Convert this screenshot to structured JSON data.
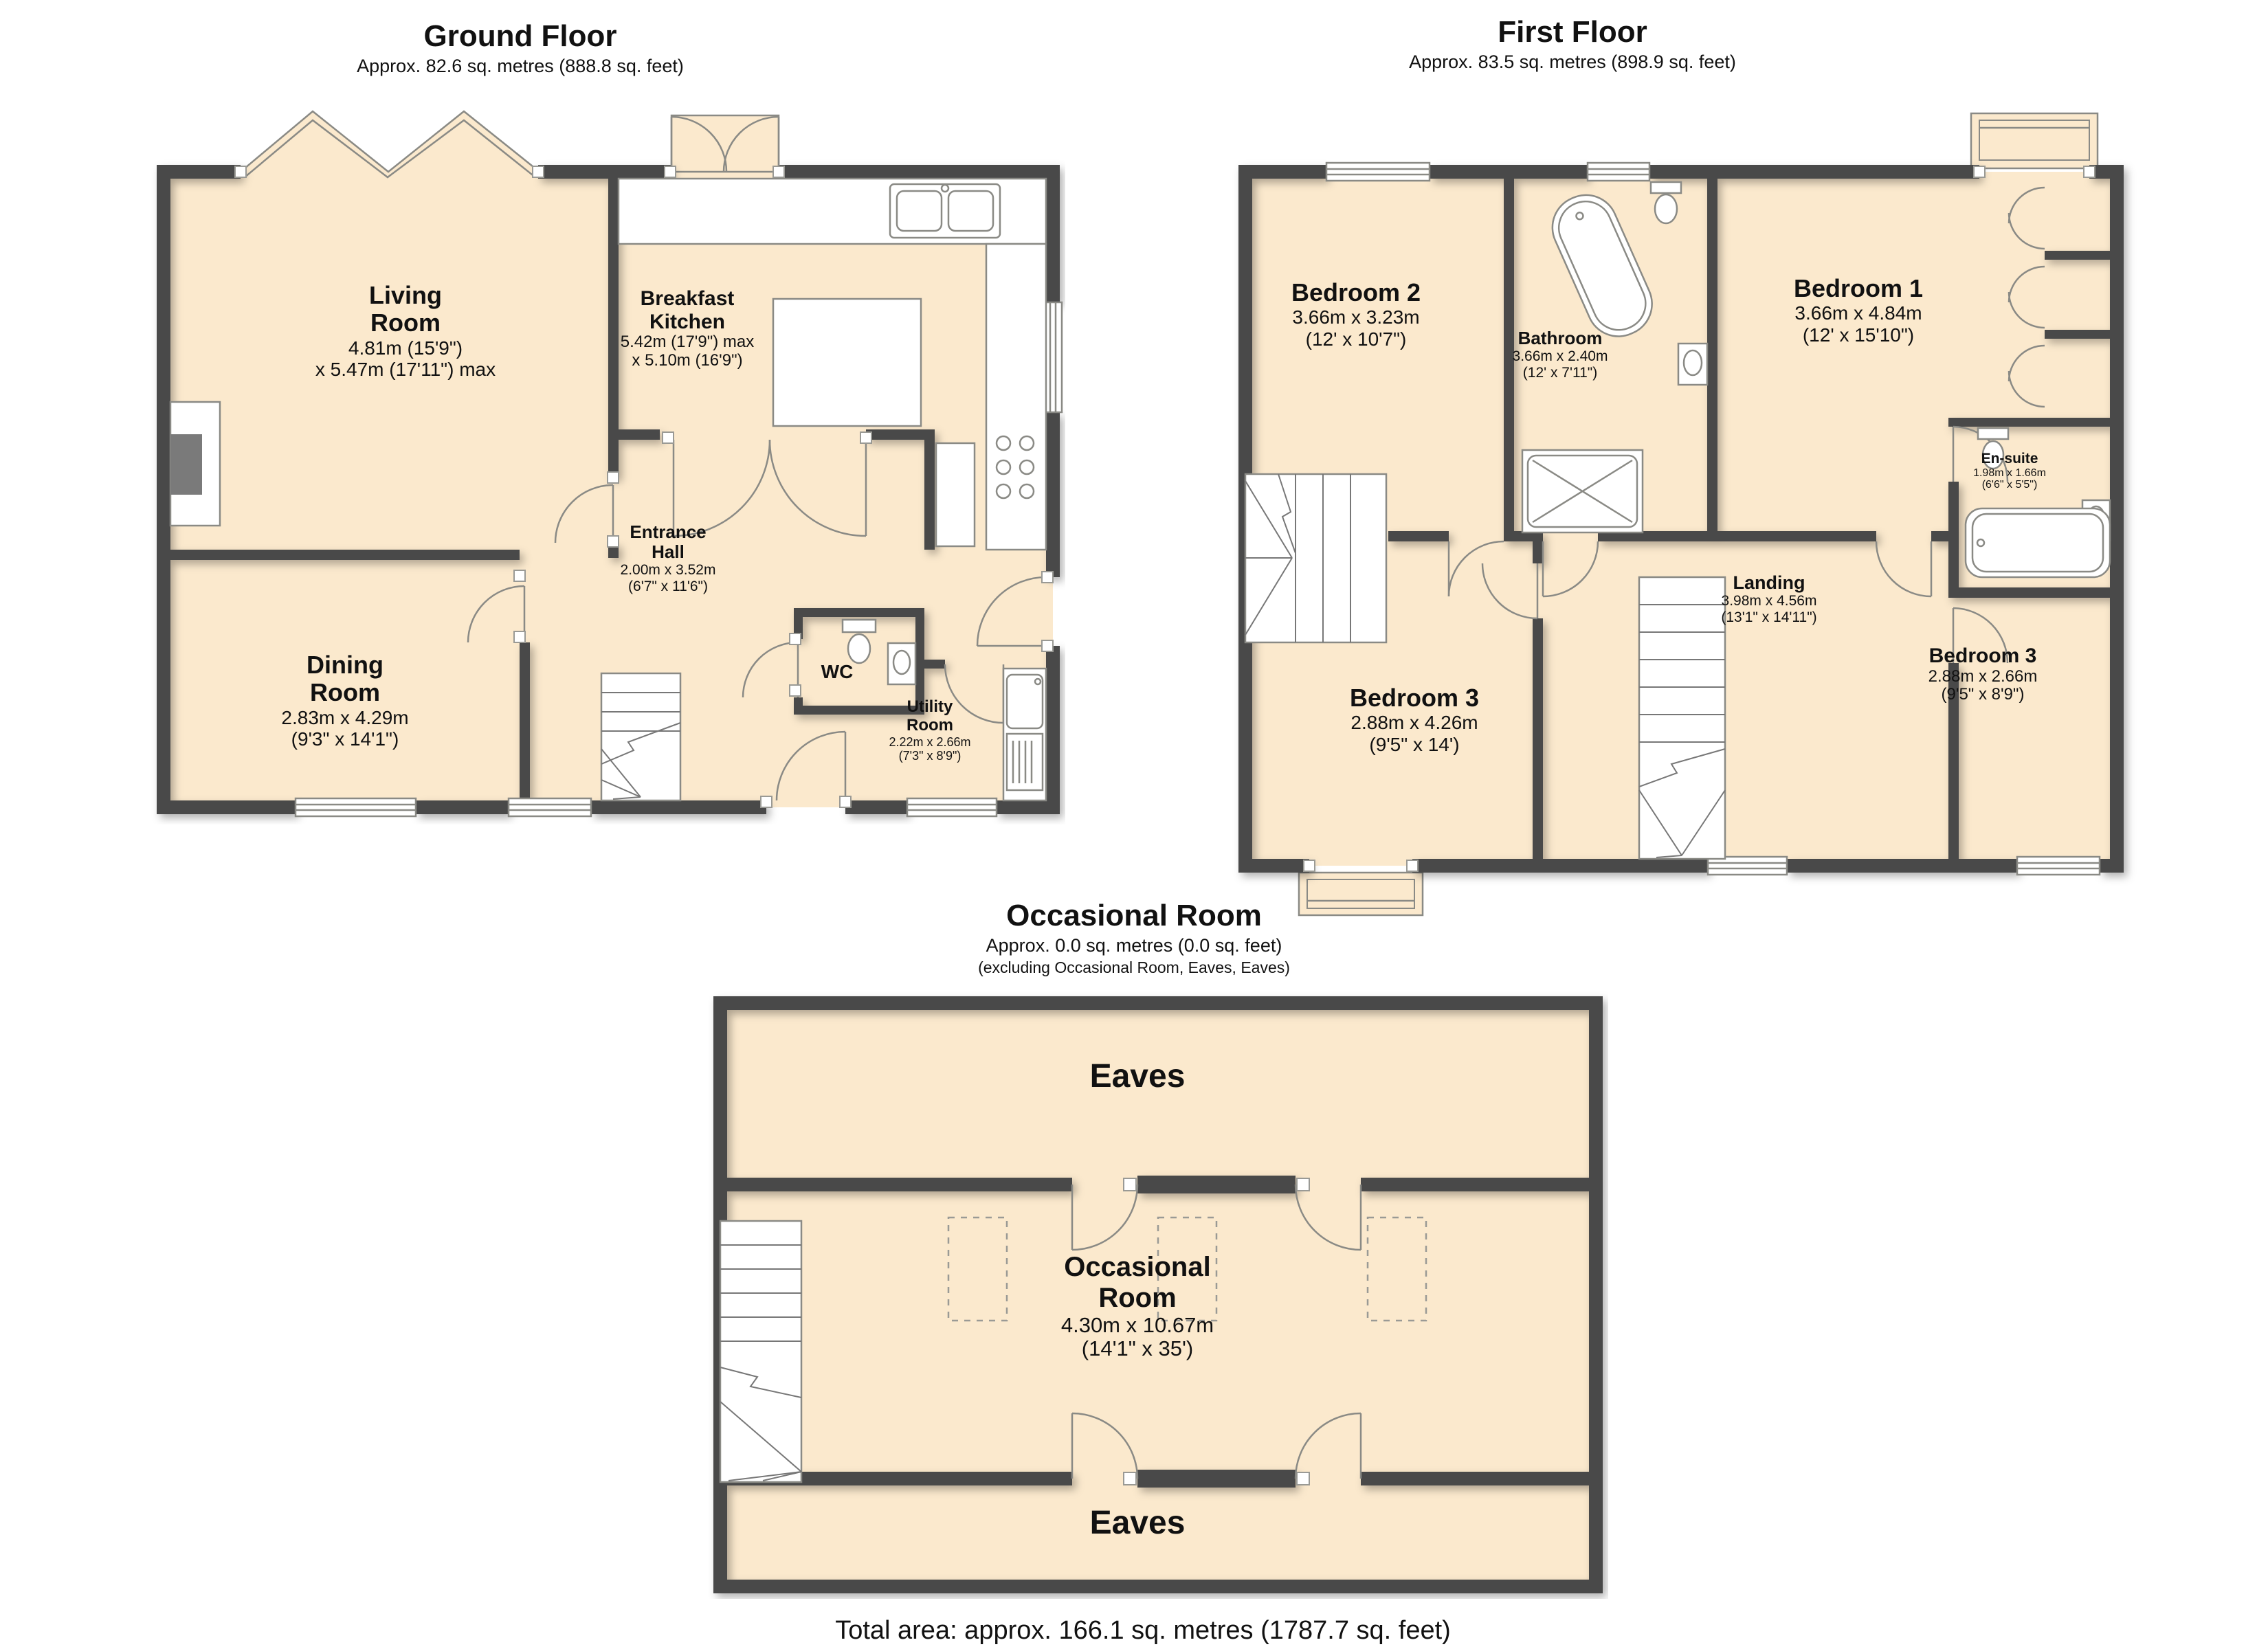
{
  "floors": {
    "ground": {
      "title": "Ground Floor",
      "subtitle": "Approx. 82.6 sq. metres (888.8 sq. feet)",
      "rooms": {
        "living": {
          "name1": "Living",
          "name2": "Room",
          "dim1": "4.81m (15'9\")",
          "dim2": "x 5.47m (17'11\") max"
        },
        "kitchen": {
          "name1": "Breakfast",
          "name2": "Kitchen",
          "dim1": "5.42m (17'9\") max",
          "dim2": "x 5.10m (16'9\")"
        },
        "entrance": {
          "name1": "Entrance",
          "name2": "Hall",
          "dim1": "2.00m x 3.52m",
          "dim2": "(6'7\" x 11'6\")"
        },
        "dining": {
          "name1": "Dining",
          "name2": "Room",
          "dim1": "2.83m x 4.29m",
          "dim2": "(9'3\" x 14'1\")"
        },
        "wc": {
          "name": "WC"
        },
        "utility": {
          "name1": "Utility",
          "name2": "Room",
          "dim1": "2.22m x 2.66m",
          "dim2": "(7'3\" x 8'9\")"
        }
      }
    },
    "first": {
      "title": "First Floor",
      "subtitle": "Approx. 83.5 sq. metres (898.9 sq. feet)",
      "rooms": {
        "bedroom2": {
          "name": "Bedroom 2",
          "dim1": "3.66m x 3.23m",
          "dim2": "(12' x 10'7\")"
        },
        "bathroom": {
          "name": "Bathroom",
          "dim1": "3.66m x 2.40m",
          "dim2": "(12' x 7'11\")"
        },
        "bedroom1": {
          "name": "Bedroom 1",
          "dim1": "3.66m x 4.84m",
          "dim2": "(12' x 15'10\")"
        },
        "ensuite": {
          "name": "En-suite",
          "dim1": "1.98m x 1.66m",
          "dim2": "(6'6\" x 5'5\")"
        },
        "landing": {
          "name": "Landing",
          "dim1": "3.98m x 4.56m",
          "dim2": "(13'1\" x 14'11\")"
        },
        "bedroom3_left": {
          "name": "Bedroom 3",
          "dim1": "2.88m x 4.26m",
          "dim2": "(9'5\" x 14')"
        },
        "bedroom3_right": {
          "name": "Bedroom 3",
          "dim1": "2.88m x 2.66m",
          "dim2": "(9'5\" x 8'9\")"
        }
      }
    },
    "occasional": {
      "title": "Occasional Room",
      "subtitle": "Approx. 0.0 sq. metres (0.0 sq. feet)",
      "subtitle2": "(excluding Occasional Room, Eaves, Eaves)",
      "rooms": {
        "eaves_top": {
          "name": "Eaves"
        },
        "occasional": {
          "name1": "Occasional",
          "name2": "Room",
          "dim1": "4.30m x 10.67m",
          "dim2": "(14'1\" x 35')"
        },
        "eaves_bottom": {
          "name": "Eaves"
        }
      }
    }
  },
  "footer": {
    "total_area": "Total area: approx. 166.1 sq. metres (1787.7 sq. feet)"
  },
  "colors": {
    "wall": "#4a4a4a",
    "floor": "#fbe9cd",
    "outline": "#8a8a85"
  }
}
